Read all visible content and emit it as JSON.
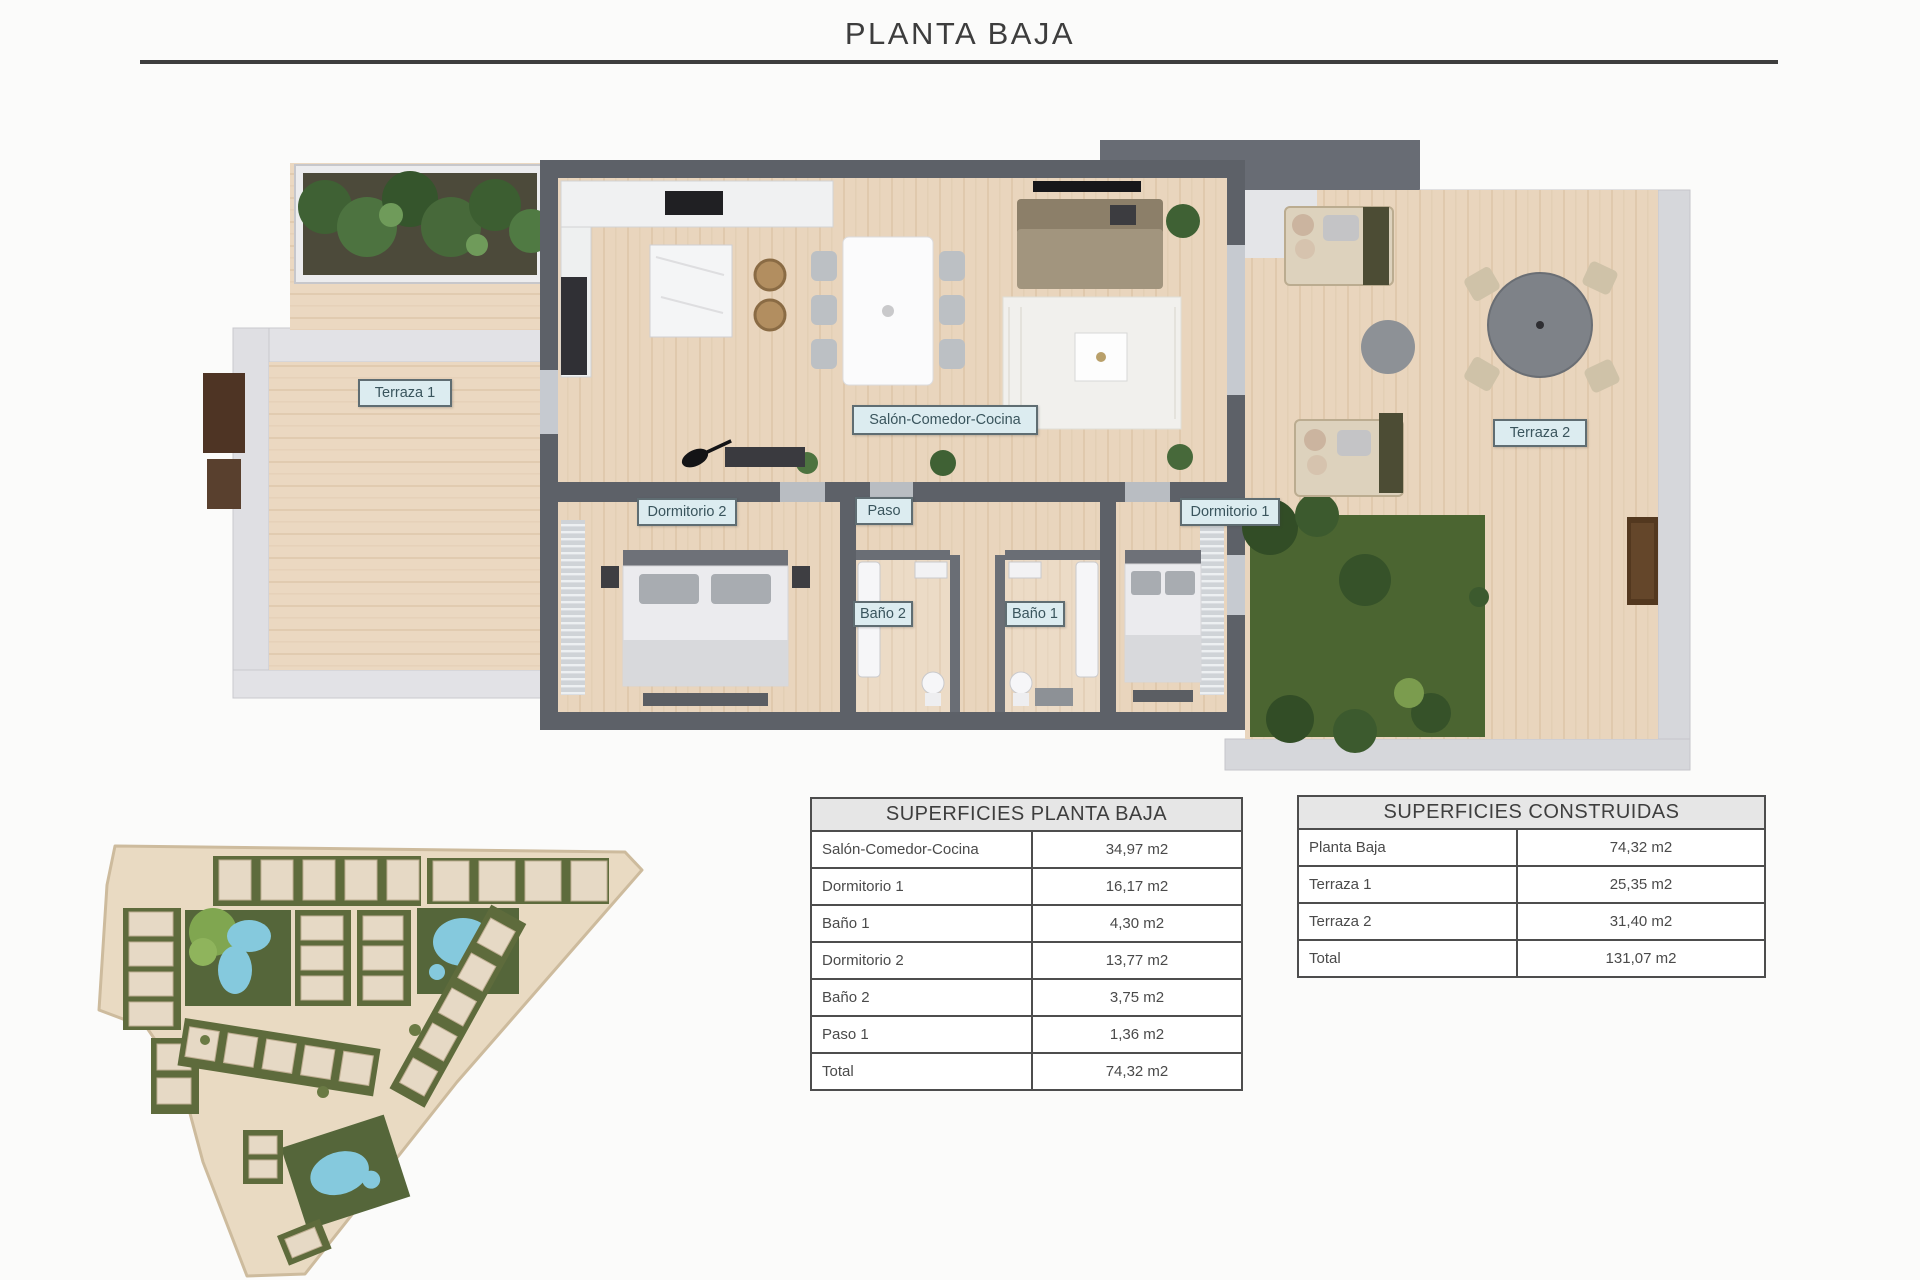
{
  "page": {
    "title": "PLANTA BAJA"
  },
  "floor_plan": {
    "room_labels": [
      {
        "label": "Terraza 1"
      },
      {
        "label": "Salón-Comedor-Cocina"
      },
      {
        "label": "Dormitorio 2"
      },
      {
        "label": "Paso"
      },
      {
        "label": "Dormitorio 1"
      },
      {
        "label": "Baño 2"
      },
      {
        "label": "Baño 1"
      },
      {
        "label": "Terraza 2"
      }
    ]
  },
  "tables": {
    "planta_baja": {
      "title": "SUPERFICIES PLANTA BAJA",
      "rows": [
        {
          "label": "Salón-Comedor-Cocina",
          "value": "34,97 m2"
        },
        {
          "label": "Dormitorio 1",
          "value": "16,17 m2"
        },
        {
          "label": "Baño 1",
          "value": "4,30 m2"
        },
        {
          "label": "Dormitorio 2",
          "value": "13,77 m2"
        },
        {
          "label": "Baño 2",
          "value": "3,75 m2"
        },
        {
          "label": "Paso 1",
          "value": "1,36 m2"
        },
        {
          "label": "Total",
          "value": "74,32 m2"
        }
      ]
    },
    "construidas": {
      "title": "SUPERFICIES CONSTRUIDAS",
      "rows": [
        {
          "label": "Planta Baja",
          "value": "74,32 m2"
        },
        {
          "label": "Terraza 1",
          "value": "25,35 m2"
        },
        {
          "label": "Terraza 2",
          "value": "31,40 m2"
        },
        {
          "label": "Total",
          "value": "131,07 m2"
        }
      ]
    }
  },
  "colors": {
    "rule": "#3e3e3e",
    "wall_dark": "#5d6168",
    "wall_light": "#dfdfe3",
    "wood": "#ead7c0",
    "label_bg": "#dcecf0",
    "grass": "#4b6531",
    "pool": "#85c9dd",
    "table_header_bg": "#e6e6e6"
  }
}
